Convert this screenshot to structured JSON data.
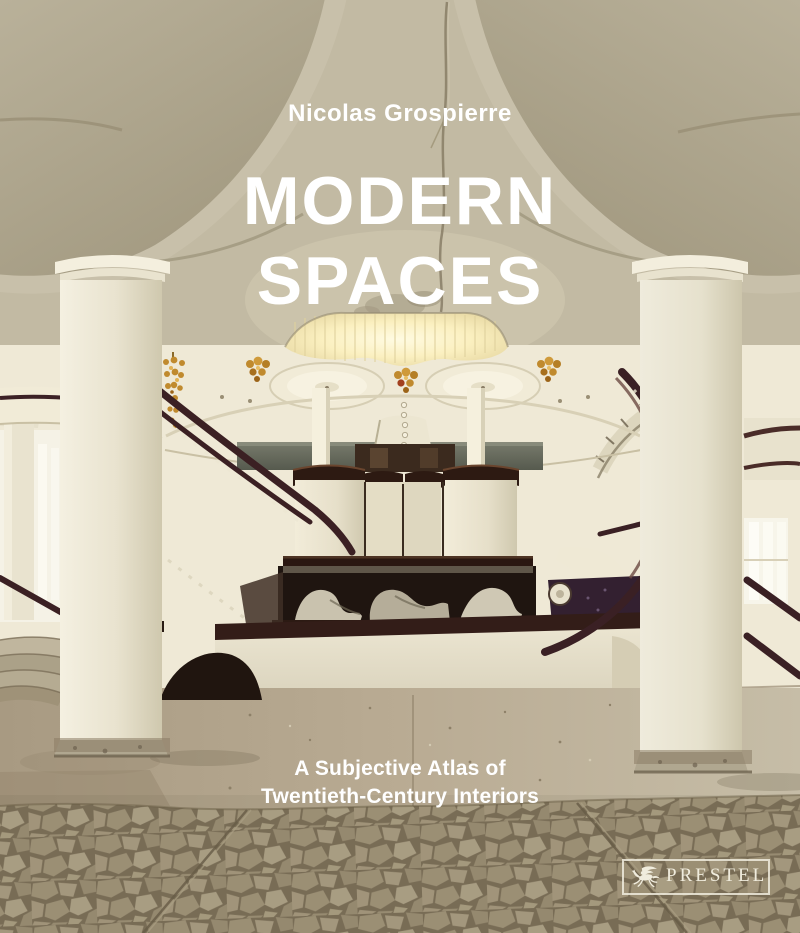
{
  "book_cover": {
    "author": "Nicolas Grospierre",
    "title": {
      "line1": "MODERN",
      "line2": "SPACES"
    },
    "subtitle": {
      "line1": "A Subjective Atlas of",
      "line2": "Twentieth-Century Interiors"
    },
    "publisher": {
      "name": "PRESTEL",
      "logo_icon": "pegasus-icon"
    },
    "photo_alt": "Modernist lobby: two white columns with mushroom capitals, curved staircases with dark railings, central cluster of cylindrical piers under a glowing ceiling opening with amber chandeliers, mosaic stone floor",
    "colors": {
      "cover_text": "#ffffff",
      "logo_text": "#f0ecdd",
      "ceiling_greige": "#aea58d",
      "ceiling_rim": "#c8c0aa",
      "wall_cream": "#efe9d6",
      "skylight_glow": "#fdf3c8",
      "chandelier_gold": "#c08a2e",
      "railing_brown": "#3b2023",
      "column_cream": "#ece6d2",
      "cylinder_cap_brown": "#2d1a12",
      "parapet_green": "#6e7164",
      "floor_concrete": "#b5a78e",
      "mosaic_joint": "#7d7059",
      "mosaic_stone": "#a2957a"
    }
  }
}
